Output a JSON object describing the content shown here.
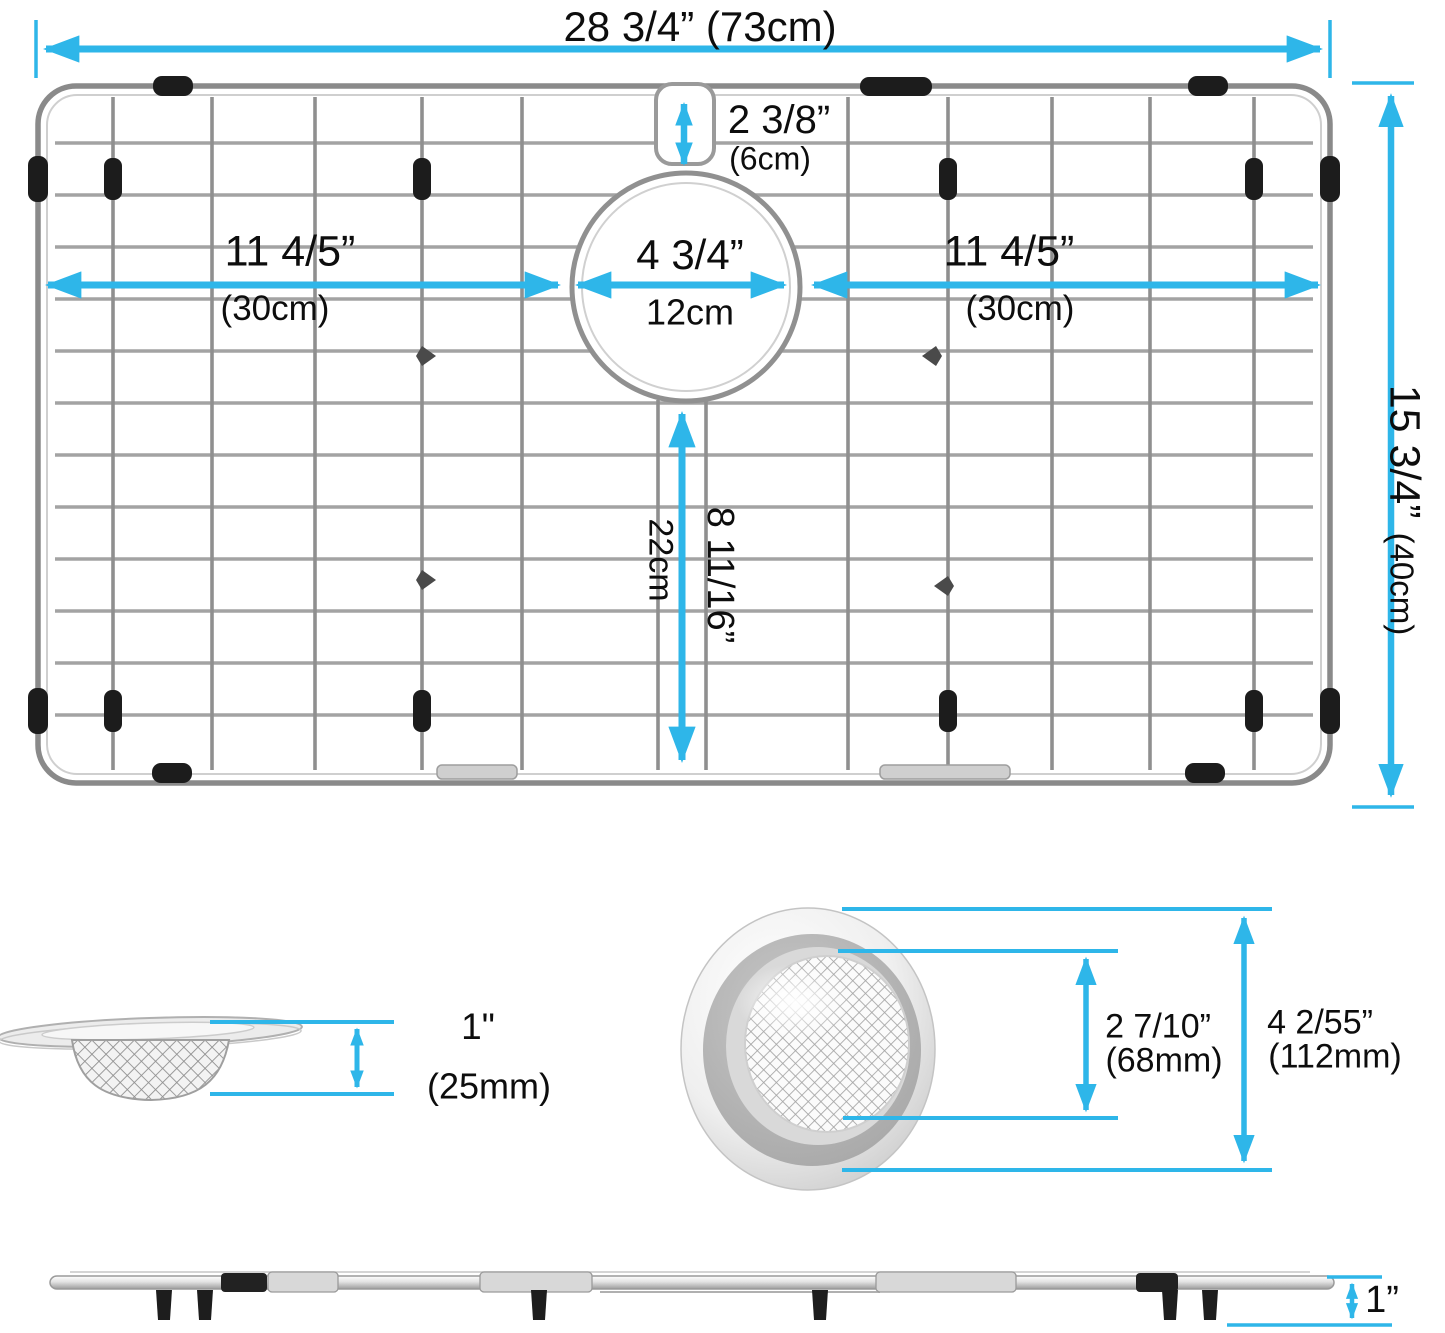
{
  "colors": {
    "dimension": "#2eb6e9",
    "wire": "#a0a0a0",
    "frame": "#8a8a8a",
    "clip": "#1c1c1c"
  },
  "grid_top": {
    "overall_width_in": "28 3/4”",
    "overall_width_cm": "(73cm)",
    "notch_in": "2 3/8”",
    "notch_cm": "(6cm)",
    "left_span_in": "11 4/5”",
    "left_span_cm": "(30cm)",
    "hole_in": "4 3/4”",
    "hole_cm": "12cm",
    "right_span_in": "11 4/5”",
    "right_span_cm": "(30cm)",
    "hole_to_bottom_in": "8 11/16”",
    "hole_to_bottom_cm": "22cm",
    "overall_height_in": "15 3/4”",
    "overall_height_cm": "(40cm)"
  },
  "strainer_side": {
    "height_in": "1\"",
    "height_mm": "(25mm)"
  },
  "strainer_top": {
    "inner_in": "2 7/10”",
    "inner_mm": "(68mm)",
    "outer_in": "4 2/55”",
    "outer_mm": "(112mm)"
  },
  "grid_side": {
    "height_in": "1”"
  }
}
